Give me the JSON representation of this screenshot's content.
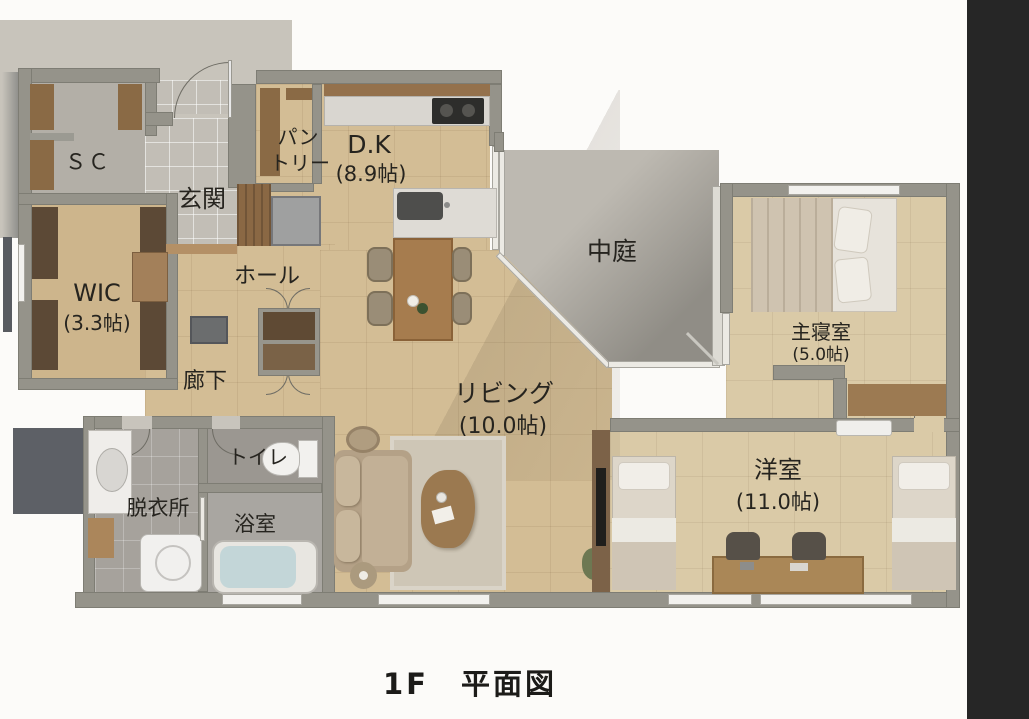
{
  "title": {
    "text": "1F　平面図"
  },
  "rooms": {
    "sc": {
      "label": "ＳＣ"
    },
    "genkan": {
      "label": "玄関"
    },
    "pantry": {
      "line1": "パン",
      "line2": "トリー"
    },
    "dk": {
      "label": "D.K",
      "size": "(8.9帖)"
    },
    "courtyard": {
      "label": "中庭"
    },
    "wic": {
      "label": "WIC",
      "size": "(3.3帖)"
    },
    "hall": {
      "label": "ホール"
    },
    "corridor": {
      "label": "廊下"
    },
    "living": {
      "label": "リビング",
      "size": "(10.0帖)"
    },
    "master": {
      "label": "主寝室",
      "size": "(5.0帖)"
    },
    "toilet": {
      "label": "トイレ"
    },
    "dressing": {
      "label": "脱衣所"
    },
    "bath": {
      "label": "浴室"
    },
    "western": {
      "label": "洋室",
      "size": "(11.0帖)"
    }
  },
  "colors": {
    "wall": "#95938a",
    "wood_floor": "#d3bd95",
    "concrete": "#c8c4bb",
    "courtyard": "#b4b0a8",
    "side_strip": "#262626",
    "text": "#26241f"
  }
}
